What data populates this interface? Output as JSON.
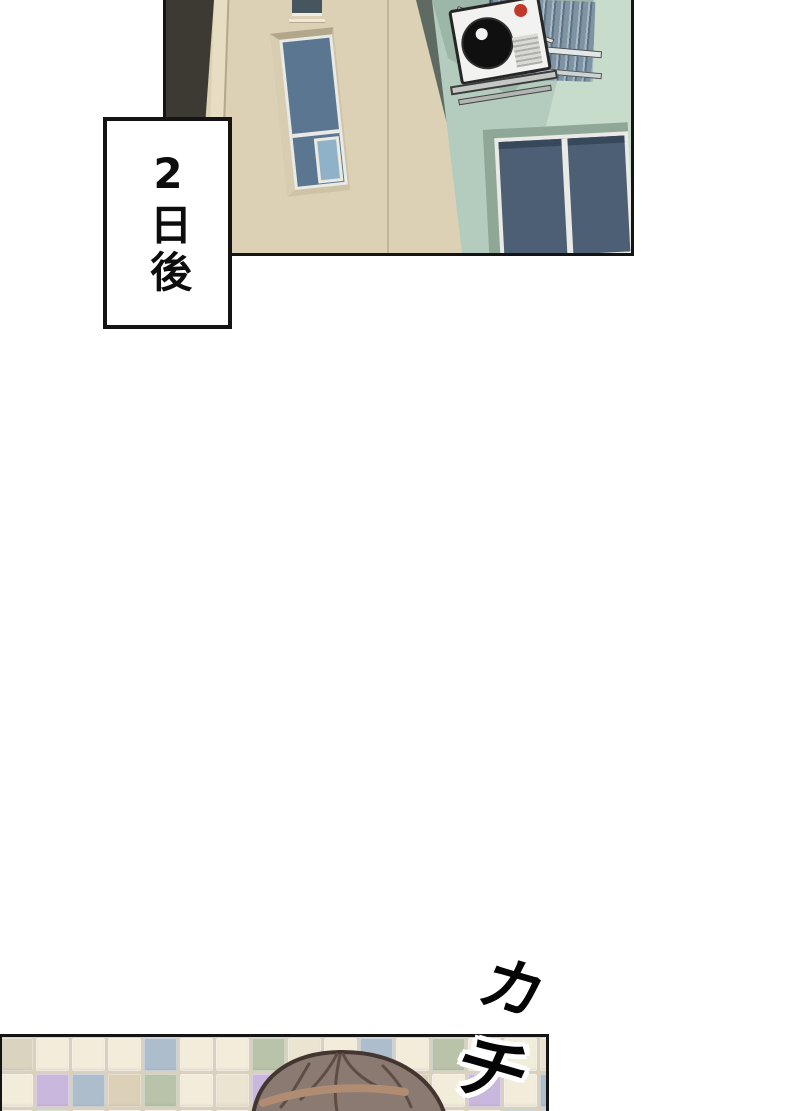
{
  "page": {
    "background": "#ffffff",
    "ink": "#141414"
  },
  "caption": {
    "text": "2日後"
  },
  "sfx": {
    "chars": [
      "カ",
      "チ"
    ]
  },
  "palette": {
    "ink": "#141414",
    "wall_beige": "#dcd1b5",
    "wall_mint": "#b3ccbd",
    "wall_mint_light": "#c8dccb",
    "wall_mint_dark": "#9cb6a7",
    "recess_mint": "#8fa796",
    "trim_brown": "#8d6e51",
    "glass_arch": "#4a86ac",
    "glass_blue": "#5a7690",
    "glass_light": "#8fb2c8",
    "glass_slate": "#47565e",
    "glass_slate2": "#4c5f74",
    "frame_white": "#e9eae6",
    "ac_red": "#c0392b",
    "grout": "#d9d1bd",
    "hair_brown": "#8b7a71",
    "hair_outline": "#43352f",
    "hair_strand": "#5e4d45",
    "hair_highlight": "#b08c72"
  },
  "tiles": {
    "palette": {
      "c": "#f2ecdb",
      "d": "#ebe4d0",
      "t": "#ddd0b8",
      "l": "#c9b7dd",
      "b": "#aebdcc",
      "s": "#b8c3a9",
      "m": "#c3d5c1",
      "g": "#d9d3c0"
    },
    "rows": [
      "gcccbccsdcbcsccd",
      "clbtscdlccctclcb",
      "cmccccclccdcccbb"
    ]
  }
}
